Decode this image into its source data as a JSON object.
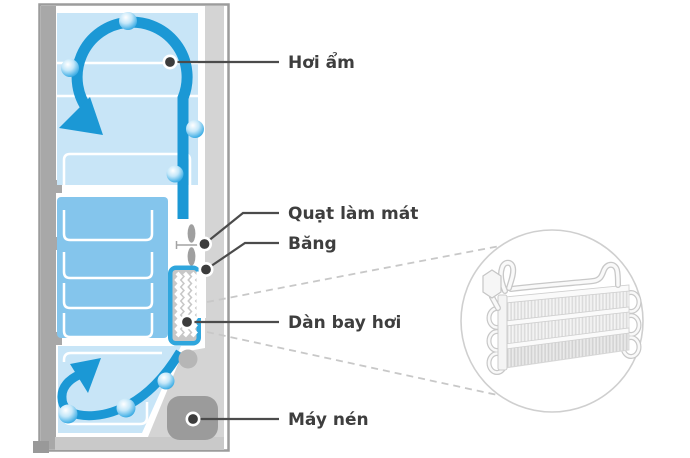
{
  "labels": {
    "moisture": "Hơi ẩm",
    "cooling_fan": "Quạt làm mát",
    "ice": "Băng",
    "evaporator": "Dàn bay hơi",
    "compressor": "Máy nén"
  },
  "colors": {
    "airflow_blue": "#1b98d5",
    "compartment_light_blue": "#c8e5f7",
    "freezer_blue": "#84c5ec",
    "evaporator_frame_blue": "#2fa6dd",
    "cabinet_gray": "#a8a8a8",
    "panel_gray": "#d4d4d4",
    "compressor_gray": "#9b9b9b",
    "leader_line_gray": "#4b4b4b",
    "label_text_gray": "#3e3e3e"
  },
  "icons": {
    "water_droplet": "water-droplet-icon",
    "cooling_fan": "cooling-fan-icon",
    "airflow_arrow": "airflow-arrow-icon",
    "magnifier_circle": "magnifier-inset-circle"
  }
}
